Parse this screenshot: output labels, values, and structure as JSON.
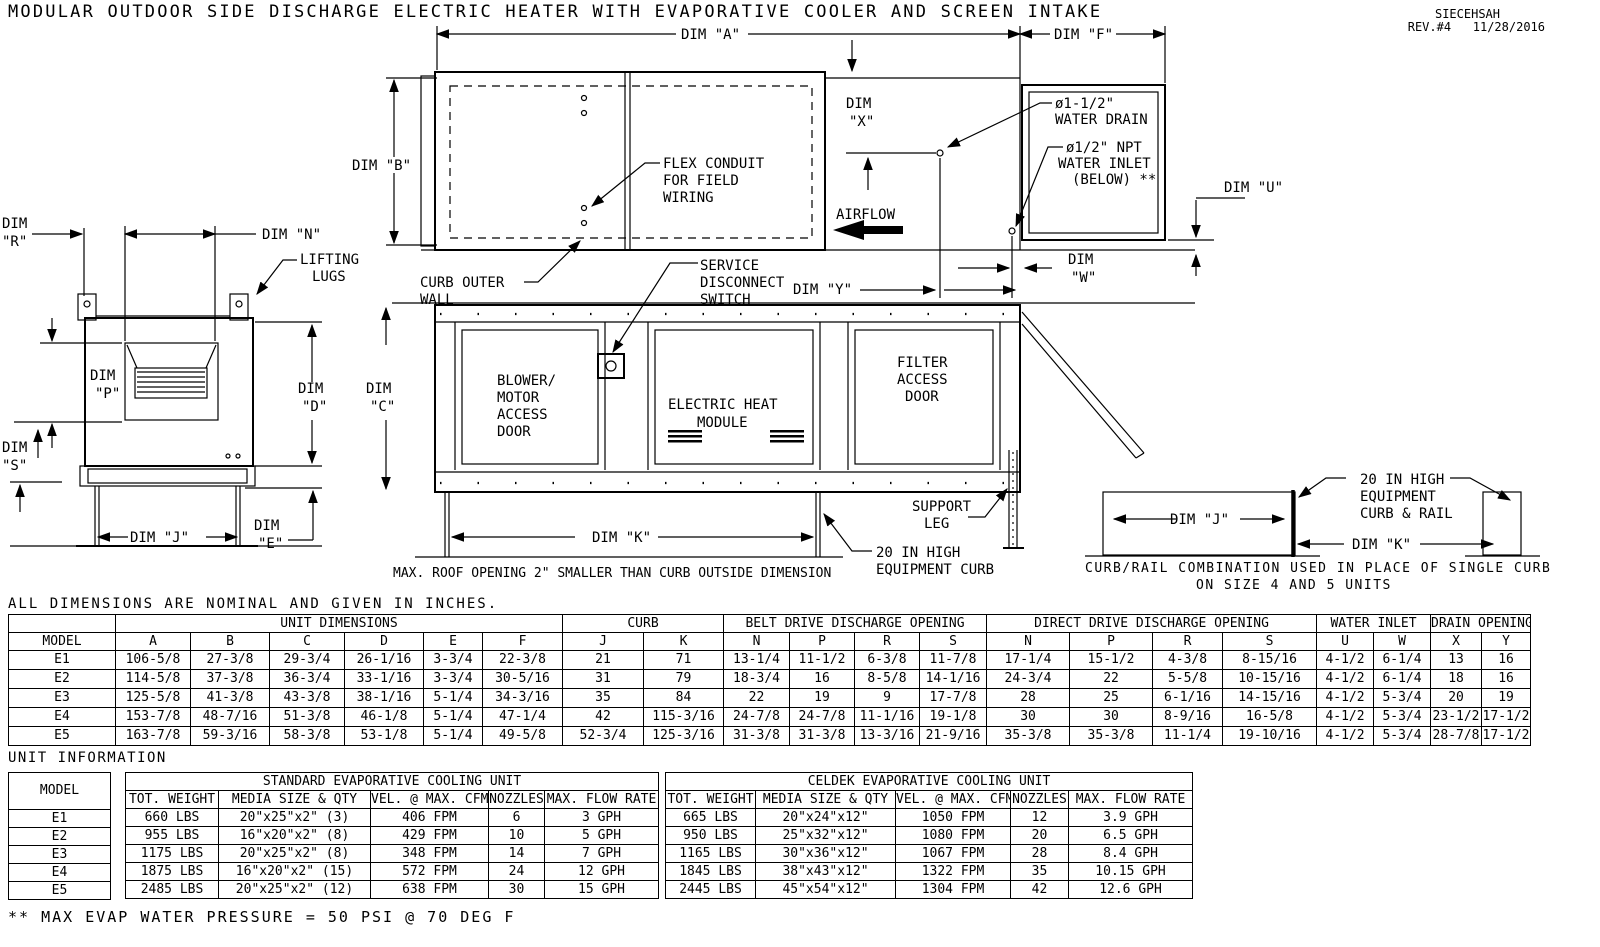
{
  "meta": {
    "title": "MODULAR OUTDOOR SIDE DISCHARGE ELECTRIC HEATER WITH EVAPORATIVE COOLER AND SCREEN INTAKE",
    "code": "SIECEHSAH",
    "rev": "REV.#4   11/28/2016"
  },
  "drawing": {
    "dims": {
      "word": "DIM",
      "a": "DIM \"A\"",
      "f": "DIM \"F\"",
      "b": "DIM \"B\"",
      "n": "DIM \"N\"",
      "u": "DIM \"U\"",
      "y": "DIM \"Y\"",
      "j": "DIM \"J\"",
      "k": "DIM \"K\"",
      "r": "\"R\"",
      "x": "\"X\"",
      "w": "\"W\"",
      "p": "\"P\"",
      "d": "\"D\"",
      "c": "\"C\"",
      "s": "\"S\"",
      "e": "\"E\""
    },
    "ann": {
      "lifting": [
        "LIFTING",
        "LUGS"
      ],
      "drain": [
        "ø1-1/2\"",
        "WATER DRAIN"
      ],
      "inlet": [
        "ø1/2\" NPT",
        "WATER INLET",
        "(BELOW) **"
      ],
      "airflow": "AIRFLOW",
      "flex": [
        "FLEX CONDUIT",
        "FOR FIELD",
        "WIRING"
      ],
      "curb_wall": [
        "CURB OUTER",
        "WALL"
      ],
      "switch": [
        "SERVICE",
        "DISCONNECT",
        "SWITCH"
      ],
      "blower": [
        "BLOWER/",
        "MOTOR",
        "ACCESS",
        "DOOR"
      ],
      "heat": [
        "ELECTRIC HEAT",
        "MODULE"
      ],
      "filter": [
        "FILTER",
        "ACCESS",
        "DOOR"
      ],
      "leg": [
        "SUPPORT",
        "LEG"
      ],
      "curb20": [
        "20 IN HIGH",
        "EQUIPMENT CURB"
      ],
      "rail20": [
        "20 IN HIGH",
        "EQUIPMENT",
        "CURB & RAIL"
      ],
      "roof_note": "MAX. ROOF OPENING 2\" SMALLER THAN CURB OUTSIDE DIMENSION",
      "rail_note": [
        "CURB/RAIL COMBINATION USED IN PLACE OF SINGLE CURB",
        "ON SIZE 4 AND 5 UNITS"
      ]
    }
  },
  "inches_note": "ALL DIMENSIONS ARE NOMINAL AND GIVEN IN INCHES.",
  "dimension_table": {
    "groups": [
      "",
      "UNIT DIMENSIONS",
      "CURB",
      "BELT DRIVE DISCHARGE OPENING",
      "DIRECT DRIVE DISCHARGE OPENING",
      "WATER INLET",
      "DRAIN OPENING"
    ],
    "columns": [
      "MODEL",
      "A",
      "B",
      "C",
      "D",
      "E",
      "F",
      "J",
      "K",
      "N",
      "P",
      "R",
      "S",
      "N",
      "P",
      "R",
      "S",
      "U",
      "W",
      "X",
      "Y"
    ],
    "rows": [
      [
        "E1",
        "106-5/8",
        "27-3/8",
        "29-3/4",
        "26-1/16",
        "3-3/4",
        "22-3/8",
        "21",
        "71",
        "13-1/4",
        "11-1/2",
        "6-3/8",
        "11-7/8",
        "17-1/4",
        "15-1/2",
        "4-3/8",
        "8-15/16",
        "4-1/2",
        "6-1/4",
        "13",
        "16"
      ],
      [
        "E2",
        "114-5/8",
        "37-3/8",
        "36-3/4",
        "33-1/16",
        "3-3/4",
        "30-5/16",
        "31",
        "79",
        "18-3/4",
        "16",
        "8-5/8",
        "14-1/16",
        "24-3/4",
        "22",
        "5-5/8",
        "10-15/16",
        "4-1/2",
        "6-1/4",
        "18",
        "16"
      ],
      [
        "E3",
        "125-5/8",
        "41-3/8",
        "43-3/8",
        "38-1/16",
        "5-1/4",
        "34-3/16",
        "35",
        "84",
        "22",
        "19",
        "9",
        "17-7/8",
        "28",
        "25",
        "6-1/16",
        "14-15/16",
        "4-1/2",
        "5-3/4",
        "20",
        "19"
      ],
      [
        "E4",
        "153-7/8",
        "48-7/16",
        "51-3/8",
        "46-1/8",
        "5-1/4",
        "47-1/4",
        "42",
        "115-3/16",
        "24-7/8",
        "24-7/8",
        "11-1/16",
        "19-1/8",
        "30",
        "30",
        "8-9/16",
        "16-5/8",
        "4-1/2",
        "5-3/4",
        "23-1/2",
        "17-1/2"
      ],
      [
        "E5",
        "163-7/8",
        "59-3/16",
        "58-3/8",
        "53-1/8",
        "5-1/4",
        "49-5/8",
        "52-3/4",
        "125-3/16",
        "31-3/8",
        "31-3/8",
        "13-3/16",
        "21-9/16",
        "35-3/8",
        "35-3/8",
        "11-1/4",
        "19-10/16",
        "4-1/2",
        "5-3/4",
        "28-7/8",
        "17-1/2"
      ]
    ]
  },
  "unit_information": {
    "title": "UNIT INFORMATION",
    "model_header": "MODEL",
    "models": [
      "E1",
      "E2",
      "E3",
      "E4",
      "E5"
    ],
    "standard": {
      "title": "STANDARD EVAPORATIVE COOLING UNIT",
      "columns": [
        "TOT. WEIGHT",
        "MEDIA SIZE & QTY",
        "VEL. @ MAX. CFM",
        "NOZZLES",
        "MAX. FLOW RATE"
      ],
      "rows": [
        [
          "660 LBS",
          "20\"x25\"x2\" (3)",
          "406 FPM",
          "6",
          "3 GPH"
        ],
        [
          "955 LBS",
          "16\"x20\"x2\" (8)",
          "429 FPM",
          "10",
          "5 GPH"
        ],
        [
          "1175 LBS",
          "20\"x25\"x2\" (8)",
          "348 FPM",
          "14",
          "7 GPH"
        ],
        [
          "1875 LBS",
          "16\"x20\"x2\" (15)",
          "572 FPM",
          "24",
          "12 GPH"
        ],
        [
          "2485 LBS",
          "20\"x25\"x2\" (12)",
          "638 FPM",
          "30",
          "15 GPH"
        ]
      ]
    },
    "celdek": {
      "title": "CELDEK EVAPORATIVE COOLING UNIT",
      "columns": [
        "TOT. WEIGHT",
        "MEDIA SIZE & QTY",
        "VEL. @ MAX. CFM",
        "NOZZLES",
        "MAX. FLOW RATE"
      ],
      "rows": [
        [
          "665 LBS",
          "20\"x24\"x12\"",
          "1050 FPM",
          "12",
          "3.9 GPH"
        ],
        [
          "950 LBS",
          "25\"x32\"x12\"",
          "1080 FPM",
          "20",
          "6.5 GPH"
        ],
        [
          "1165 LBS",
          "30\"x36\"x12\"",
          "1067 FPM",
          "28",
          "8.4 GPH"
        ],
        [
          "1845 LBS",
          "38\"x43\"x12\"",
          "1322 FPM",
          "35",
          "10.15 GPH"
        ],
        [
          "2445 LBS",
          "45\"x54\"x12\"",
          "1304 FPM",
          "42",
          "12.6 GPH"
        ]
      ]
    }
  },
  "footnote": "** MAX EVAP WATER PRESSURE = 50 PSI @ 70 DEG F"
}
